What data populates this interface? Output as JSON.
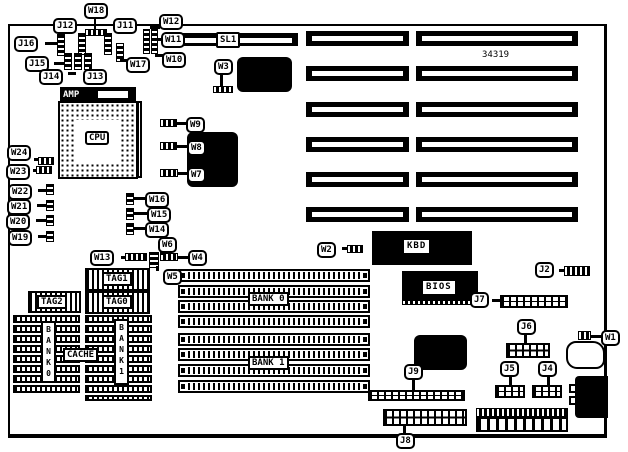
{
  "board": {
    "part_number": "34319",
    "cpu_label": "CPU",
    "cpu_socket_brand": "AMP",
    "slot1_label": "SL1",
    "chip_labels": {
      "kbd": "KBD",
      "bios": "BIOS"
    },
    "cache_labels": {
      "tag0": "TAG0",
      "tag1": "TAG1",
      "tag2": "TAG2",
      "cache": "CACHE",
      "bank0": "BANK0",
      "bank1": "BANK1"
    },
    "memory_labels": {
      "bank0": "BANK 0",
      "bank1": "BANK 1"
    },
    "jumpers": {
      "w1": "W1",
      "w2": "W2",
      "w3": "W3",
      "w4": "W4",
      "w5": "W5",
      "w6": "W6",
      "w7": "W7",
      "w8": "W8",
      "w9": "W9",
      "w10": "W10",
      "w11": "W11",
      "w12": "W12",
      "w13": "W13",
      "w14": "W14",
      "w15": "W15",
      "w16": "W16",
      "w17": "W17",
      "w18": "W18",
      "w19": "W19",
      "w20": "W20",
      "w21": "W21",
      "w22": "W22",
      "w23": "W23",
      "w24": "W24"
    },
    "connectors": {
      "j2": "J2",
      "j4": "J4",
      "j5": "J5",
      "j6": "J6",
      "j7": "J7",
      "j8": "J8",
      "j9": "J9",
      "j11": "J11",
      "j12": "J12",
      "j13": "J13",
      "j14": "J14",
      "j15": "J15",
      "j16": "J16"
    }
  }
}
